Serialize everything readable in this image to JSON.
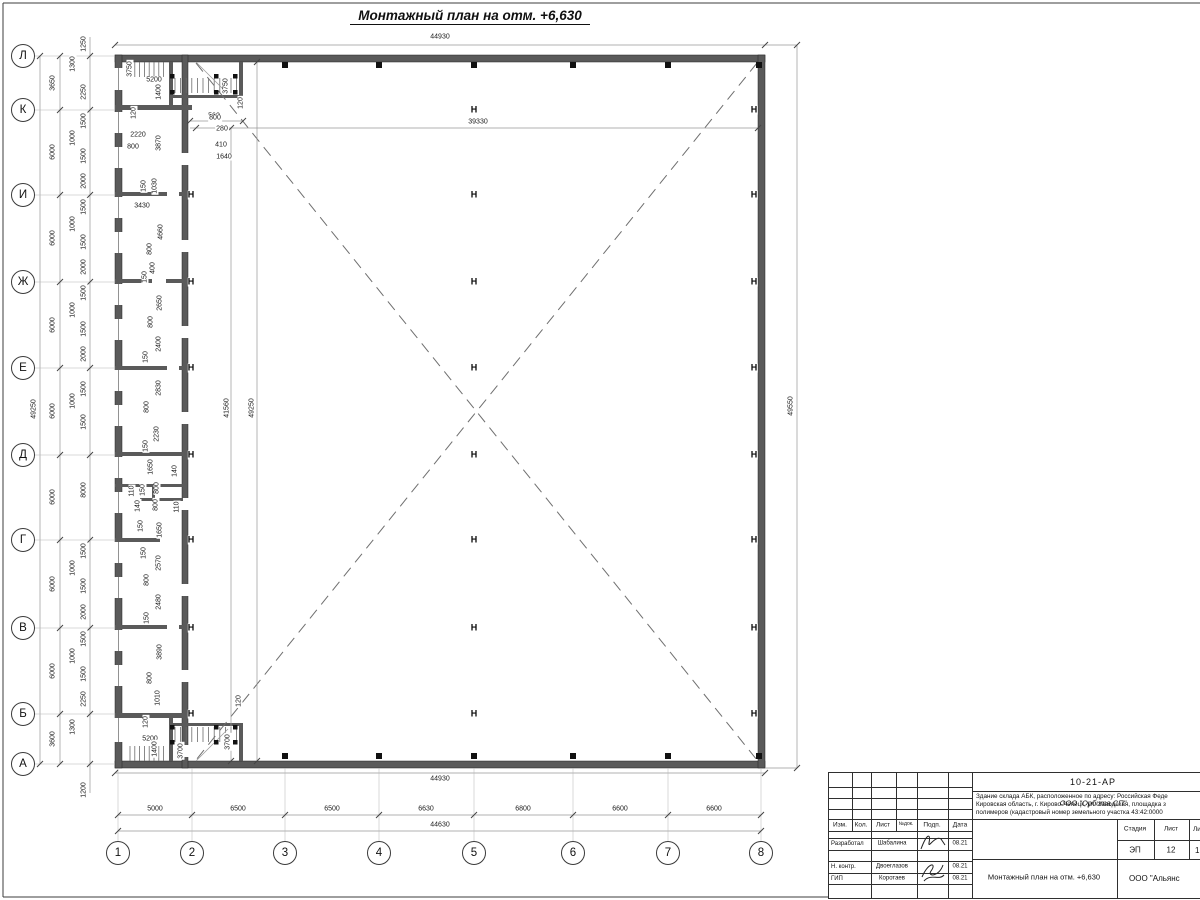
{
  "title": "Монтажный план на отм. +6,630",
  "colors": {
    "wall": "#5a5a5a",
    "line": "#8a8a8a",
    "dash": "#6f6f6f",
    "ink": "#111111"
  },
  "axes": {
    "left": [
      {
        "label": "Л",
        "y": 56
      },
      {
        "label": "К",
        "y": 110
      },
      {
        "label": "И",
        "y": 195
      },
      {
        "label": "Ж",
        "y": 282
      },
      {
        "label": "Е",
        "y": 368
      },
      {
        "label": "Д",
        "y": 455
      },
      {
        "label": "Г",
        "y": 540
      },
      {
        "label": "В",
        "y": 628
      },
      {
        "label": "Б",
        "y": 714
      },
      {
        "label": "А",
        "y": 764
      }
    ],
    "left_cx": 23,
    "bottom": [
      {
        "label": "1",
        "x": 118
      },
      {
        "label": "2",
        "x": 192
      },
      {
        "label": "3",
        "x": 285
      },
      {
        "label": "4",
        "x": 379
      },
      {
        "label": "5",
        "x": 474
      },
      {
        "label": "6",
        "x": 573
      },
      {
        "label": "7",
        "x": 668
      },
      {
        "label": "8",
        "x": 761
      }
    ],
    "bottom_cy": 853
  },
  "h_marks": [
    {
      "x": 191,
      "rows": [
        195,
        282,
        368,
        455,
        540,
        628,
        714
      ]
    },
    {
      "x": 474,
      "rows": [
        110,
        195,
        282,
        368,
        455,
        540,
        628,
        714
      ]
    },
    {
      "x": 754,
      "rows": [
        110,
        195,
        282,
        368,
        455,
        540,
        628,
        714
      ]
    }
  ],
  "wall_columns": {
    "xs": [
      285,
      379,
      474,
      573,
      668
    ],
    "top_y": 62,
    "bottom_y": 753
  },
  "dims": [
    [
      "44930",
      440,
      37,
      0
    ],
    [
      "44930",
      440,
      779,
      0
    ],
    [
      "5000",
      155,
      809,
      0
    ],
    [
      "6500",
      238,
      809,
      0
    ],
    [
      "6500",
      332,
      809,
      0
    ],
    [
      "6630",
      426,
      809,
      0
    ],
    [
      "6800",
      523,
      809,
      0
    ],
    [
      "6600",
      620,
      809,
      0
    ],
    [
      "6600",
      714,
      809,
      0
    ],
    [
      "44630",
      440,
      825,
      0
    ],
    [
      "49250",
      34,
      409,
      1
    ],
    [
      "3650",
      53,
      83,
      1
    ],
    [
      "6000",
      53,
      152,
      1
    ],
    [
      "6000",
      53,
      238,
      1
    ],
    [
      "6000",
      53,
      325,
      1
    ],
    [
      "6000",
      53,
      411,
      1
    ],
    [
      "6000",
      53,
      497,
      1
    ],
    [
      "6000",
      53,
      584,
      1
    ],
    [
      "6000",
      53,
      671,
      1
    ],
    [
      "3600",
      53,
      739,
      1
    ],
    [
      "1250",
      84,
      44,
      1
    ],
    [
      "1300",
      73,
      64,
      1
    ],
    [
      "2250",
      84,
      92,
      1
    ],
    [
      "1500",
      84,
      121,
      1
    ],
    [
      "1000",
      73,
      138,
      1
    ],
    [
      "1500",
      84,
      156,
      1
    ],
    [
      "2000",
      84,
      181,
      1
    ],
    [
      "1500",
      84,
      207,
      1
    ],
    [
      "1000",
      73,
      224,
      1
    ],
    [
      "1500",
      84,
      242,
      1
    ],
    [
      "2000",
      84,
      267,
      1
    ],
    [
      "1500",
      84,
      293,
      1
    ],
    [
      "1000",
      73,
      310,
      1
    ],
    [
      "1500",
      84,
      329,
      1
    ],
    [
      "2000",
      84,
      354,
      1
    ],
    [
      "1500",
      84,
      389,
      1
    ],
    [
      "1000",
      73,
      401,
      1
    ],
    [
      "1500",
      84,
      422,
      1
    ],
    [
      "8000",
      84,
      490,
      1
    ],
    [
      "1500",
      84,
      551,
      1
    ],
    [
      "1000",
      73,
      568,
      1
    ],
    [
      "1500",
      84,
      586,
      1
    ],
    [
      "2000",
      84,
      612,
      1
    ],
    [
      "1500",
      84,
      639,
      1
    ],
    [
      "1000",
      73,
      656,
      1
    ],
    [
      "1500",
      84,
      674,
      1
    ],
    [
      "2250",
      84,
      699,
      1
    ],
    [
      "1300",
      73,
      727,
      1
    ],
    [
      "1200",
      84,
      790,
      1
    ],
    [
      "49550",
      791,
      406,
      1
    ],
    [
      "39330",
      478,
      122,
      0
    ],
    [
      "41560",
      227,
      408,
      1
    ],
    [
      "49250",
      252,
      408,
      1
    ],
    [
      "560",
      214,
      116,
      0
    ],
    [
      "3750",
      130,
      69,
      1
    ],
    [
      "5200",
      154,
      80,
      0
    ],
    [
      "1400",
      159,
      92,
      1
    ],
    [
      "3750",
      226,
      86,
      1
    ],
    [
      "120",
      241,
      103,
      1
    ],
    [
      "120",
      134,
      113,
      1
    ],
    [
      "2220",
      138,
      135,
      0
    ],
    [
      "800",
      133,
      147,
      0
    ],
    [
      "3870",
      159,
      143,
      1
    ],
    [
      "800",
      215,
      118,
      0
    ],
    [
      "280",
      222,
      129,
      0
    ],
    [
      "410",
      221,
      145,
      0
    ],
    [
      "1640",
      224,
      157,
      0
    ],
    [
      "150",
      144,
      186,
      1
    ],
    [
      "1030",
      155,
      186,
      1
    ],
    [
      "3430",
      142,
      206,
      0
    ],
    [
      "4660",
      161,
      232,
      1
    ],
    [
      "800",
      150,
      249,
      1
    ],
    [
      "400",
      153,
      268,
      1
    ],
    [
      "150",
      145,
      277,
      1
    ],
    [
      "2650",
      160,
      303,
      1
    ],
    [
      "800",
      151,
      322,
      1
    ],
    [
      "2400",
      159,
      344,
      1
    ],
    [
      "150",
      146,
      357,
      1
    ],
    [
      "2830",
      159,
      388,
      1
    ],
    [
      "800",
      147,
      407,
      1
    ],
    [
      "2230",
      157,
      434,
      1
    ],
    [
      "150",
      146,
      446,
      1
    ],
    [
      "1650",
      151,
      467,
      1
    ],
    [
      "140",
      175,
      471,
      1
    ],
    [
      "110",
      132,
      491,
      1
    ],
    [
      "150",
      143,
      490,
      1
    ],
    [
      "800",
      157,
      488,
      1
    ],
    [
      "140",
      138,
      506,
      1
    ],
    [
      "800",
      156,
      505,
      1
    ],
    [
      "110",
      177,
      507,
      1
    ],
    [
      "150",
      141,
      526,
      1
    ],
    [
      "1650",
      160,
      530,
      1
    ],
    [
      "150",
      144,
      553,
      1
    ],
    [
      "2570",
      159,
      563,
      1
    ],
    [
      "800",
      147,
      580,
      1
    ],
    [
      "2480",
      159,
      602,
      1
    ],
    [
      "150",
      147,
      618,
      1
    ],
    [
      "3890",
      160,
      652,
      1
    ],
    [
      "800",
      150,
      678,
      1
    ],
    [
      "1010",
      158,
      698,
      1
    ],
    [
      "120",
      146,
      722,
      1
    ],
    [
      "5200",
      150,
      739,
      0
    ],
    [
      "1400",
      155,
      749,
      1
    ],
    [
      "3700",
      181,
      751,
      1
    ],
    [
      "120",
      239,
      701,
      1
    ],
    [
      "3700",
      228,
      742,
      1
    ]
  ],
  "titleblock": {
    "doc_code": "10-21-АР",
    "desc_line1": "Здание склада АБК, расположенное по адресу: Российская Феде",
    "desc_line2": "Кировская область, г. Кирово-Чепецк, ул. Заводская, площадка з",
    "desc_line3": "полимеров (кадастровый номер земельного участка 43:42:0000",
    "header_cells": [
      "Изм.",
      "Кол.",
      "Лист",
      "№док.",
      "Подп.",
      "Дата"
    ],
    "rows": [
      {
        "role": "Разработал",
        "name": "Шабалина",
        "date": "08.21"
      },
      {
        "role": "Н. контр.",
        "name": "Двоеглазов",
        "date": "08.21"
      },
      {
        "role": "ГИП",
        "name": "Коротаев",
        "date": "08.21"
      }
    ],
    "org": "ООО \"Орбита СП\"",
    "stage_label": "Стадия",
    "sheet_label": "Лист",
    "sheets_label": "Ли",
    "stage": "ЭП",
    "sheet": "12",
    "sheets": "1",
    "plan_name": "Монтажный план на отм. +6,630",
    "company": "ООО \"Альянс"
  }
}
